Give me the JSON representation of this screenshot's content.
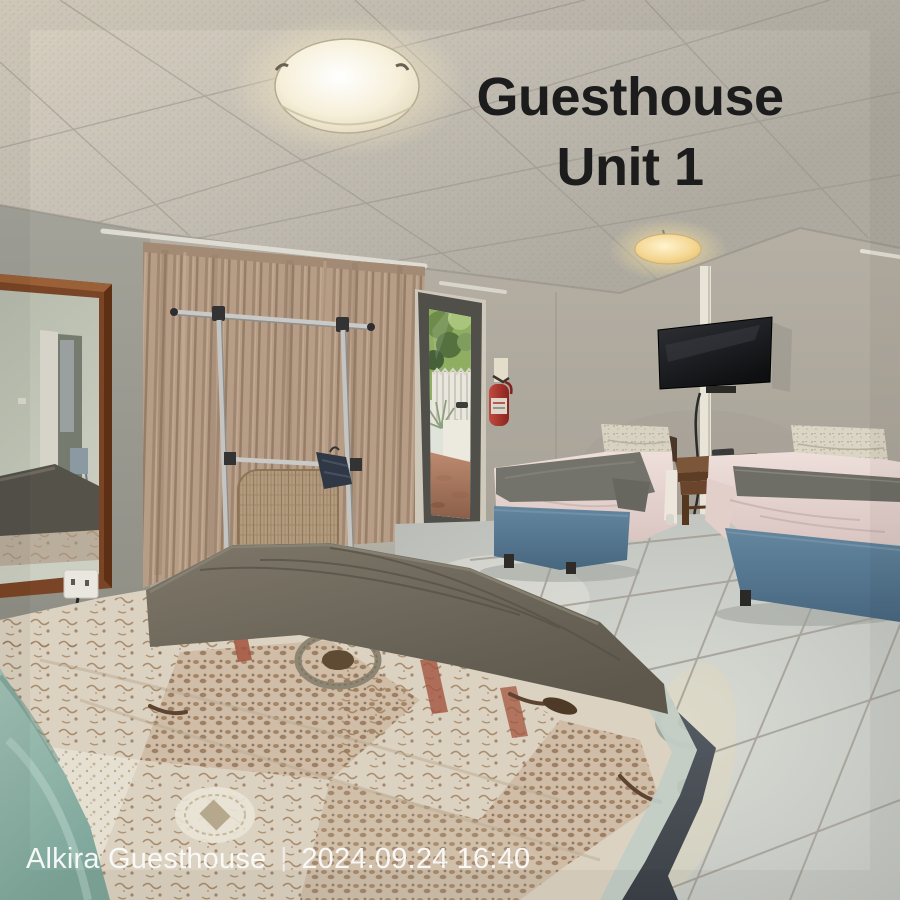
{
  "overlay": {
    "title_line1": "Guesthouse",
    "title_line2": "Unit 1",
    "watermark": {
      "name": "Alkira Guesthouse",
      "separator": "|",
      "timestamp": "2024.09.24 16:40"
    }
  },
  "colors": {
    "title_text": "#1c1c1c",
    "watermark_text": "#fafaf9",
    "ceiling": "#c4beb3",
    "wall_right": "#aba69b",
    "wall_left": "#9b9b92",
    "curtain": "#b59b84",
    "floor_tile": "#cacdc7",
    "bed_base_blue": "#5a7e9a",
    "duvet_pink": "#e6d5d1",
    "blanket_gray": "#6e6e66",
    "quilt_cream": "#dcd2c1",
    "quilt_brown": "#8a684c",
    "teal_blanket": "#94b7ab",
    "mirror_frame_wood": "#7a4526",
    "tv_screen": "#1a1b1d",
    "fire_extinguisher_red": "#a83028",
    "outdoor_foliage": "#8fae62",
    "outdoor_paving": "#a5745a"
  }
}
